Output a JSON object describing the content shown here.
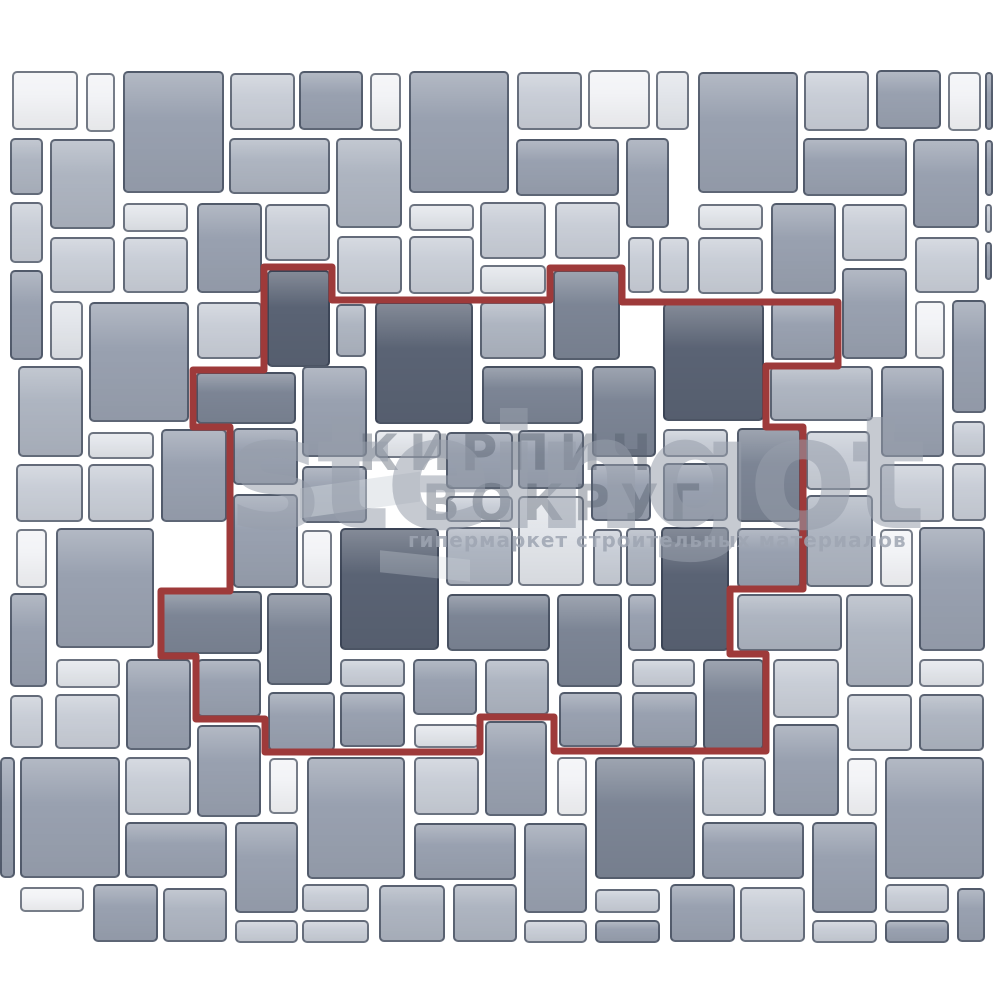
{
  "meta": {
    "description": "Paving stone laying pattern scheme with highlighted repeating unit",
    "canvas": {
      "width": 1000,
      "height": 1000,
      "background": "#ffffff",
      "pattern_clip_bottom": 943
    }
  },
  "palette": {
    "D": "#5A6374",
    "MD": "#7C8595",
    "M": "#99A1B0",
    "LM": "#AEB5C1",
    "L": "#C9CED7",
    "VL": "#E2E5EA",
    "W": "#F2F3F6",
    "tile_border": "rgba(42,51,70,0.62)",
    "outline_red": "#9E3A3A"
  },
  "pattern": {
    "tiles": [
      [
        12,
        71,
        66,
        59,
        "W"
      ],
      [
        86,
        73,
        29,
        59,
        "W"
      ],
      [
        123,
        71,
        101,
        122,
        "M"
      ],
      [
        230,
        73,
        65,
        57,
        "L"
      ],
      [
        299,
        71,
        64,
        59,
        "M"
      ],
      [
        370,
        73,
        31,
        58,
        "W"
      ],
      [
        409,
        71,
        100,
        122,
        "M"
      ],
      [
        517,
        72,
        65,
        58,
        "L"
      ],
      [
        588,
        70,
        62,
        59,
        "W"
      ],
      [
        656,
        71,
        33,
        59,
        "VL"
      ],
      [
        698,
        72,
        100,
        121,
        "M"
      ],
      [
        804,
        71,
        65,
        60,
        "L"
      ],
      [
        876,
        70,
        65,
        59,
        "M"
      ],
      [
        948,
        72,
        33,
        59,
        "W"
      ],
      [
        985,
        72,
        8,
        58,
        "M"
      ],
      [
        10,
        138,
        33,
        57,
        "LM"
      ],
      [
        50,
        139,
        65,
        90,
        "LM"
      ],
      [
        229,
        138,
        101,
        56,
        "LM"
      ],
      [
        336,
        138,
        66,
        90,
        "LM"
      ],
      [
        516,
        139,
        103,
        57,
        "M"
      ],
      [
        626,
        138,
        43,
        90,
        "M"
      ],
      [
        803,
        138,
        104,
        58,
        "M"
      ],
      [
        913,
        139,
        66,
        89,
        "M"
      ],
      [
        985,
        140,
        8,
        56,
        "M"
      ],
      [
        10,
        202,
        33,
        61,
        "L"
      ],
      [
        123,
        203,
        65,
        29,
        "VL"
      ],
      [
        197,
        203,
        65,
        90,
        "M"
      ],
      [
        265,
        204,
        65,
        57,
        "L"
      ],
      [
        409,
        204,
        65,
        27,
        "VL"
      ],
      [
        480,
        202,
        66,
        57,
        "L"
      ],
      [
        555,
        202,
        65,
        57,
        "L"
      ],
      [
        698,
        204,
        65,
        26,
        "VL"
      ],
      [
        771,
        203,
        65,
        91,
        "M"
      ],
      [
        842,
        204,
        65,
        57,
        "L"
      ],
      [
        985,
        204,
        7,
        29,
        "L"
      ],
      [
        10,
        270,
        33,
        90,
        "M"
      ],
      [
        50,
        237,
        65,
        56,
        "L"
      ],
      [
        123,
        237,
        65,
        56,
        "L"
      ],
      [
        337,
        236,
        65,
        58,
        "L"
      ],
      [
        409,
        236,
        65,
        58,
        "L"
      ],
      [
        480,
        265,
        66,
        29,
        "VL"
      ],
      [
        628,
        237,
        26,
        56,
        "L"
      ],
      [
        659,
        237,
        30,
        56,
        "L"
      ],
      [
        698,
        237,
        65,
        57,
        "L"
      ],
      [
        915,
        237,
        64,
        56,
        "L"
      ],
      [
        985,
        242,
        7,
        38,
        "M"
      ],
      [
        267,
        270,
        63,
        97,
        "D"
      ],
      [
        553,
        270,
        67,
        90,
        "MD"
      ],
      [
        771,
        302,
        65,
        58,
        "M"
      ],
      [
        842,
        268,
        65,
        91,
        "M"
      ],
      [
        915,
        301,
        30,
        58,
        "W"
      ],
      [
        952,
        300,
        34,
        113,
        "M"
      ],
      [
        663,
        303,
        101,
        118,
        "D"
      ],
      [
        197,
        302,
        65,
        57,
        "L"
      ],
      [
        50,
        301,
        33,
        59,
        "VL"
      ],
      [
        89,
        302,
        100,
        120,
        "M"
      ],
      [
        336,
        304,
        30,
        53,
        "LM"
      ],
      [
        375,
        302,
        98,
        122,
        "D"
      ],
      [
        480,
        302,
        66,
        57,
        "LM"
      ],
      [
        196,
        372,
        100,
        52,
        "MD"
      ],
      [
        18,
        366,
        65,
        91,
        "LM"
      ],
      [
        302,
        366,
        65,
        91,
        "M"
      ],
      [
        482,
        366,
        101,
        58,
        "MD"
      ],
      [
        592,
        366,
        64,
        91,
        "MD"
      ],
      [
        770,
        366,
        103,
        55,
        "LM"
      ],
      [
        881,
        366,
        63,
        91,
        "M"
      ],
      [
        952,
        421,
        33,
        36,
        "L"
      ],
      [
        952,
        463,
        34,
        58,
        "L"
      ],
      [
        88,
        432,
        66,
        27,
        "VL"
      ],
      [
        161,
        429,
        66,
        93,
        "M"
      ],
      [
        16,
        464,
        67,
        58,
        "L"
      ],
      [
        88,
        464,
        66,
        58,
        "L"
      ],
      [
        233,
        428,
        65,
        57,
        "M"
      ],
      [
        233,
        494,
        65,
        94,
        "M"
      ],
      [
        302,
        466,
        65,
        57,
        "M"
      ],
      [
        375,
        430,
        66,
        28,
        "VL"
      ],
      [
        446,
        432,
        67,
        57,
        "M"
      ],
      [
        518,
        430,
        66,
        59,
        "M"
      ],
      [
        446,
        496,
        67,
        26,
        "L"
      ],
      [
        518,
        496,
        66,
        90,
        "VL"
      ],
      [
        446,
        527,
        67,
        59,
        "LM"
      ],
      [
        591,
        464,
        60,
        57,
        "M"
      ],
      [
        593,
        529,
        29,
        57,
        "L"
      ],
      [
        626,
        528,
        30,
        58,
        "LM"
      ],
      [
        663,
        429,
        65,
        28,
        "L"
      ],
      [
        663,
        463,
        65,
        58,
        "M"
      ],
      [
        737,
        428,
        64,
        94,
        "MD"
      ],
      [
        737,
        528,
        64,
        60,
        "M"
      ],
      [
        806,
        431,
        64,
        59,
        "L"
      ],
      [
        806,
        495,
        67,
        92,
        "LM"
      ],
      [
        880,
        464,
        64,
        58,
        "L"
      ],
      [
        880,
        529,
        33,
        58,
        "W"
      ],
      [
        919,
        527,
        66,
        124,
        "M"
      ],
      [
        16,
        529,
        31,
        59,
        "W"
      ],
      [
        56,
        528,
        98,
        120,
        "M"
      ],
      [
        302,
        530,
        30,
        58,
        "W"
      ],
      [
        340,
        528,
        99,
        122,
        "D"
      ],
      [
        661,
        527,
        68,
        124,
        "D"
      ],
      [
        10,
        593,
        37,
        94,
        "M"
      ],
      [
        160,
        591,
        102,
        63,
        "MD"
      ],
      [
        267,
        593,
        65,
        92,
        "MD"
      ],
      [
        447,
        594,
        103,
        57,
        "MD"
      ],
      [
        557,
        594,
        65,
        93,
        "MD"
      ],
      [
        628,
        594,
        28,
        57,
        "M"
      ],
      [
        737,
        594,
        105,
        57,
        "LM"
      ],
      [
        846,
        594,
        67,
        93,
        "LM"
      ],
      [
        56,
        659,
        64,
        29,
        "VL"
      ],
      [
        126,
        659,
        65,
        91,
        "M"
      ],
      [
        197,
        659,
        64,
        58,
        "M"
      ],
      [
        10,
        695,
        33,
        53,
        "L"
      ],
      [
        55,
        694,
        65,
        55,
        "L"
      ],
      [
        268,
        692,
        67,
        59,
        "M"
      ],
      [
        340,
        659,
        65,
        28,
        "L"
      ],
      [
        340,
        692,
        65,
        55,
        "M"
      ],
      [
        413,
        659,
        64,
        56,
        "M"
      ],
      [
        414,
        724,
        65,
        24,
        "VL"
      ],
      [
        485,
        659,
        64,
        56,
        "LM"
      ],
      [
        485,
        721,
        62,
        95,
        "M"
      ],
      [
        559,
        692,
        63,
        55,
        "M"
      ],
      [
        632,
        659,
        63,
        28,
        "L"
      ],
      [
        632,
        692,
        65,
        56,
        "M"
      ],
      [
        703,
        659,
        61,
        91,
        "MD"
      ],
      [
        773,
        659,
        66,
        59,
        "L"
      ],
      [
        773,
        724,
        66,
        92,
        "M"
      ],
      [
        847,
        694,
        65,
        57,
        "L"
      ],
      [
        919,
        659,
        65,
        28,
        "VL"
      ],
      [
        919,
        694,
        65,
        57,
        "LM"
      ],
      [
        197,
        725,
        64,
        92,
        "M"
      ],
      [
        0,
        757,
        15,
        121,
        "M"
      ],
      [
        20,
        757,
        100,
        121,
        "M"
      ],
      [
        125,
        757,
        66,
        58,
        "L"
      ],
      [
        269,
        758,
        29,
        56,
        "W"
      ],
      [
        307,
        757,
        98,
        122,
        "M"
      ],
      [
        414,
        757,
        65,
        58,
        "L"
      ],
      [
        557,
        757,
        30,
        59,
        "W"
      ],
      [
        595,
        757,
        100,
        122,
        "MD"
      ],
      [
        702,
        757,
        64,
        59,
        "L"
      ],
      [
        847,
        758,
        30,
        58,
        "W"
      ],
      [
        885,
        757,
        99,
        122,
        "M"
      ],
      [
        125,
        822,
        102,
        56,
        "M"
      ],
      [
        235,
        822,
        63,
        91,
        "M"
      ],
      [
        414,
        823,
        102,
        57,
        "M"
      ],
      [
        524,
        823,
        63,
        90,
        "M"
      ],
      [
        702,
        822,
        102,
        57,
        "M"
      ],
      [
        812,
        822,
        65,
        91,
        "M"
      ],
      [
        20,
        887,
        64,
        25,
        "W"
      ],
      [
        93,
        884,
        65,
        58,
        "M"
      ],
      [
        163,
        888,
        64,
        54,
        "LM"
      ],
      [
        235,
        920,
        63,
        23,
        "L"
      ],
      [
        302,
        884,
        67,
        28,
        "L"
      ],
      [
        302,
        920,
        67,
        23,
        "L"
      ],
      [
        379,
        885,
        66,
        57,
        "LM"
      ],
      [
        453,
        884,
        64,
        58,
        "LM"
      ],
      [
        524,
        920,
        63,
        23,
        "L"
      ],
      [
        595,
        889,
        65,
        24,
        "L"
      ],
      [
        595,
        920,
        65,
        23,
        "M"
      ],
      [
        670,
        884,
        65,
        58,
        "M"
      ],
      [
        740,
        887,
        65,
        55,
        "L"
      ],
      [
        812,
        920,
        65,
        23,
        "L"
      ],
      [
        885,
        884,
        64,
        29,
        "L"
      ],
      [
        885,
        920,
        64,
        23,
        "M"
      ],
      [
        957,
        888,
        28,
        54,
        "M"
      ]
    ]
  },
  "outline": {
    "color": "#9E3A3A",
    "stroke_width": 7,
    "points": [
      [
        264,
        267
      ],
      [
        332,
        267
      ],
      [
        332,
        300
      ],
      [
        550,
        300
      ],
      [
        550,
        268
      ],
      [
        622,
        268
      ],
      [
        622,
        302
      ],
      [
        838,
        302
      ],
      [
        838,
        366
      ],
      [
        766,
        366
      ],
      [
        766,
        427
      ],
      [
        803,
        427
      ],
      [
        803,
        589
      ],
      [
        730,
        589
      ],
      [
        730,
        654
      ],
      [
        766,
        654
      ],
      [
        766,
        751
      ],
      [
        554,
        751
      ],
      [
        554,
        717
      ],
      [
        480,
        717
      ],
      [
        480,
        752
      ],
      [
        265,
        752
      ],
      [
        265,
        719
      ],
      [
        196,
        719
      ],
      [
        196,
        656
      ],
      [
        161,
        656
      ],
      [
        161,
        591
      ],
      [
        230,
        591
      ],
      [
        230,
        427
      ],
      [
        193,
        427
      ],
      [
        193,
        370
      ],
      [
        264,
        370
      ]
    ]
  },
  "watermark": {
    "brand": "steingot",
    "overlay_line1": "КИРПИЧ",
    "overlay_line2": "ВОКРУГ",
    "tagline": "гипермаркет строительных материалов"
  }
}
